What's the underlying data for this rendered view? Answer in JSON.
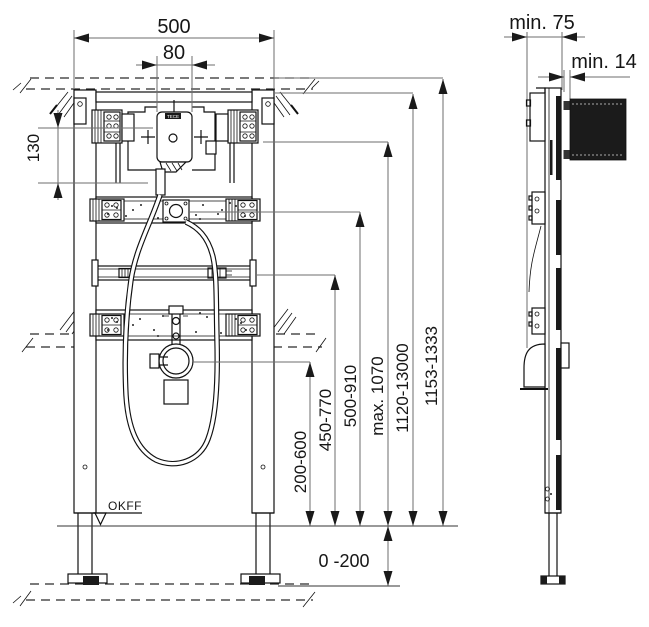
{
  "front": {
    "width_total": "500",
    "width_unit": "80",
    "offset_top": "130",
    "datum_label": "OKFF",
    "below_floor_range": "0 -200",
    "unit_brand": "TECE",
    "height_dims": [
      "200-600",
      "450-770",
      "500-910",
      "max. 1070",
      "1120-13000",
      "1153-1333"
    ]
  },
  "side": {
    "min_depth": "min. 75",
    "min_cover": "min. 14"
  }
}
